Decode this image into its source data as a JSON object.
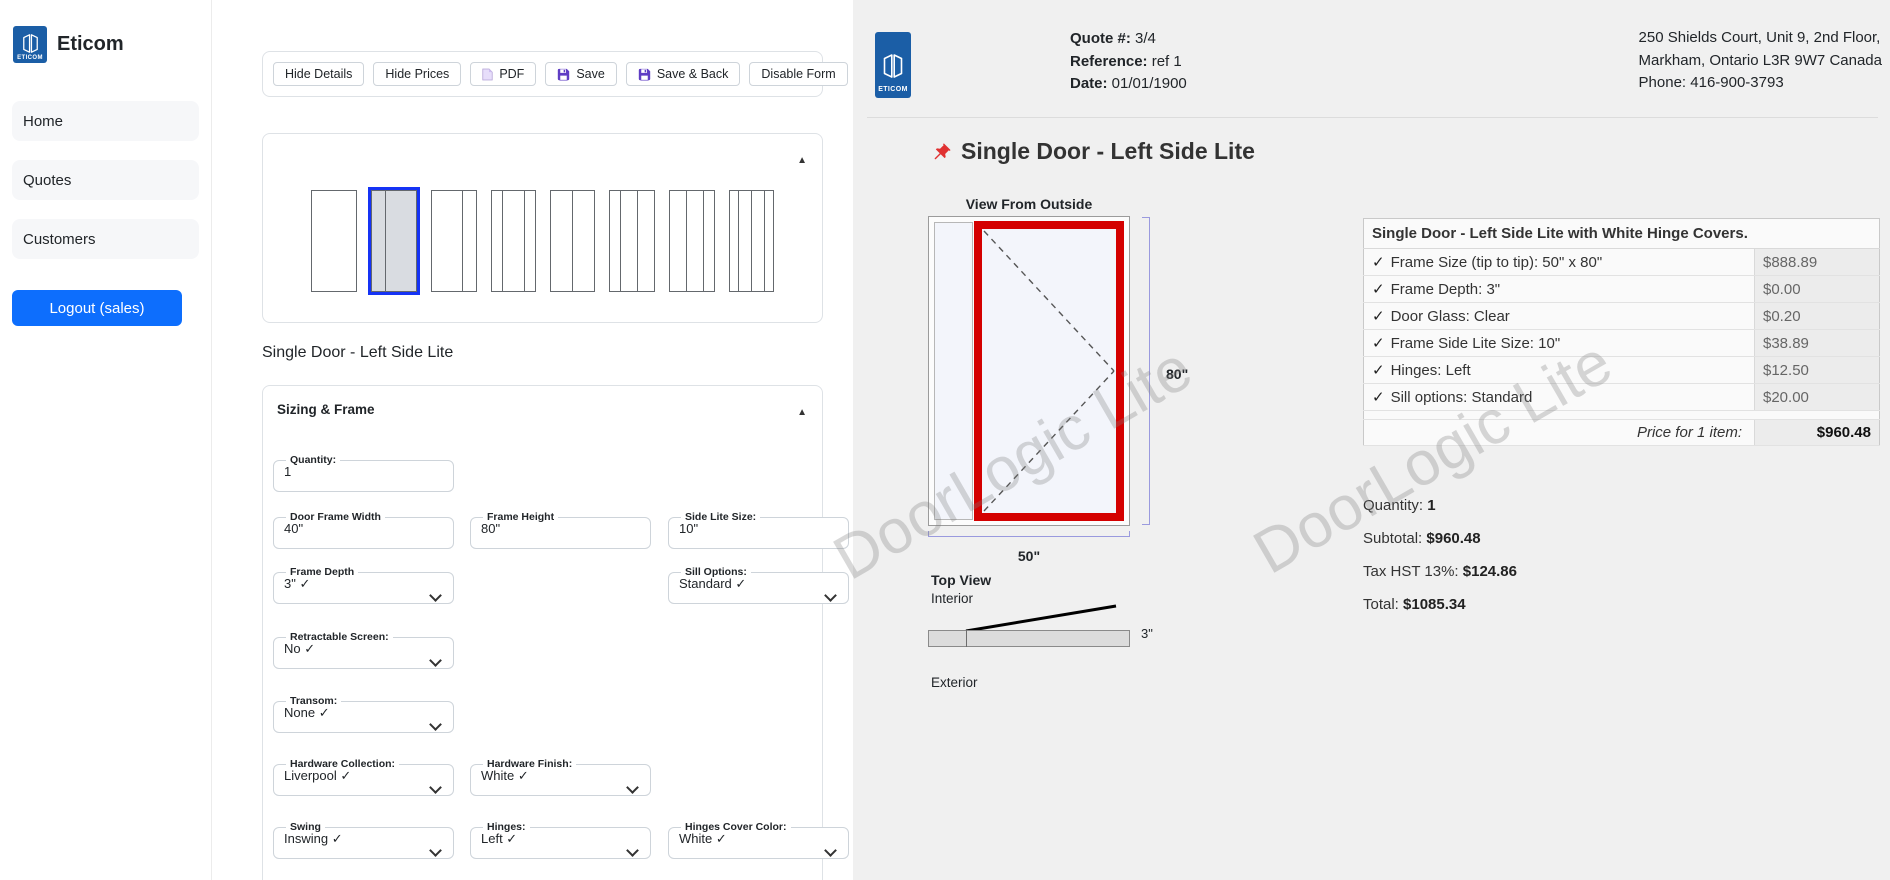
{
  "sidebar": {
    "brand": "Eticom",
    "logo_text": "ETICOM",
    "nav": [
      {
        "label": "Home"
      },
      {
        "label": "Quotes"
      },
      {
        "label": "Customers"
      }
    ],
    "logout_label": "Logout (sales)"
  },
  "toolbar": {
    "buttons": [
      {
        "label": "Hide Details",
        "icon": null
      },
      {
        "label": "Hide Prices",
        "icon": null
      },
      {
        "label": "PDF",
        "icon": "pdf-icon"
      },
      {
        "label": "Save",
        "icon": "floppy-icon"
      },
      {
        "label": "Save & Back",
        "icon": "floppy-icon"
      },
      {
        "label": "Disable Form",
        "icon": null
      }
    ]
  },
  "door_styles": {
    "selected_index": 1,
    "collapse_arrow": "▲",
    "options": [
      {
        "name": "single-door",
        "panels": [
          46
        ]
      },
      {
        "name": "single-door-left-side-lite",
        "panels": [
          15,
          32
        ]
      },
      {
        "name": "single-door-right-side-lite",
        "panels": [
          32,
          15
        ]
      },
      {
        "name": "single-door-both-side-lites",
        "panels": [
          12,
          23,
          12
        ]
      },
      {
        "name": "double-door",
        "panels": [
          23,
          23
        ]
      },
      {
        "name": "double-door-left-side-lite",
        "panels": [
          12,
          18,
          18
        ]
      },
      {
        "name": "double-door-right-side-lite",
        "panels": [
          18,
          18,
          12
        ]
      },
      {
        "name": "double-door-both-side-lites",
        "panels": [
          10,
          14,
          14,
          10
        ]
      }
    ]
  },
  "model_label": "Single Door - Left Side Lite",
  "form": {
    "section_title": "Sizing & Frame",
    "collapse_arrow": "▲",
    "fields": [
      {
        "label": "Quantity:",
        "value": "1",
        "type": "input",
        "col": 0,
        "row": 0
      },
      {
        "label": "Door Frame Width",
        "value": "40\"",
        "type": "input",
        "col": 0,
        "row": 1
      },
      {
        "label": "Frame Height",
        "value": "80\"",
        "type": "input",
        "col": 1,
        "row": 1
      },
      {
        "label": "Side Lite Size:",
        "value": "10\"",
        "type": "input",
        "col": 2,
        "row": 1
      },
      {
        "label": "Frame Depth",
        "value": "3\" ✓",
        "type": "select",
        "col": 0,
        "row": 2
      },
      {
        "label": "Sill Options:",
        "value": "Standard ✓",
        "type": "select",
        "col": 2,
        "row": 2
      },
      {
        "label": "Retractable Screen:",
        "value": "No ✓",
        "type": "select",
        "col": 0,
        "row": 3
      },
      {
        "label": "Transom:",
        "value": "None ✓",
        "type": "select",
        "col": 0,
        "row": 4
      },
      {
        "label": "Hardware Collection:",
        "value": "Liverpool ✓",
        "type": "select",
        "col": 0,
        "row": 5
      },
      {
        "label": "Hardware Finish:",
        "value": "White ✓",
        "type": "select",
        "col": 1,
        "row": 5
      },
      {
        "label": "Swing",
        "value": "Inswing ✓",
        "type": "select",
        "col": 0,
        "row": 6
      },
      {
        "label": "Hinges:",
        "value": "Left ✓",
        "type": "select",
        "col": 1,
        "row": 6
      },
      {
        "label": "Hinges Cover Color:",
        "value": "White ✓",
        "type": "select",
        "col": 2,
        "row": 6
      }
    ]
  },
  "quote_header": {
    "logo_text": "ETICOM",
    "items": [
      {
        "label": "Quote #:",
        "value": "3/4"
      },
      {
        "label": "Reference:",
        "value": "ref 1"
      },
      {
        "label": "Date:",
        "value": "01/01/1900"
      }
    ],
    "address_lines": [
      "250 Shields Court, Unit 9, 2nd Floor,",
      "Markham, Ontario L3R 9W7 Canada",
      "Phone: 416-900-3793"
    ]
  },
  "preview": {
    "title": "Single Door - Left Side Lite",
    "view_label": "View From Outside",
    "height_label": "80\"",
    "width_label": "50\"",
    "top_view_label": "Top View",
    "interior_label": "Interior",
    "exterior_label": "Exterior",
    "depth_label": "3\""
  },
  "price_table": {
    "header": "Single Door - Left Side Lite with White Hinge Covers.",
    "check_mark": "✓",
    "rows": [
      {
        "item": "Frame Size (tip to tip): 50\" x 80\"",
        "price": "$888.89"
      },
      {
        "item": "Frame Depth: 3\"",
        "price": "$0.00"
      },
      {
        "item": "Door Glass: Clear",
        "price": "$0.20"
      },
      {
        "item": "Frame Side Lite Size: 10\"",
        "price": "$38.89"
      },
      {
        "item": "Hinges: Left",
        "price": "$12.50"
      },
      {
        "item": "Sill options: Standard",
        "price": "$20.00"
      }
    ],
    "total_label": "Price for 1 item:",
    "total_value": "$960.48"
  },
  "totals": [
    {
      "label": "Quantity:",
      "value": "1"
    },
    {
      "label": "Subtotal:",
      "value": "$960.48"
    },
    {
      "label": "Tax HST 13%:",
      "value": "$124.86"
    },
    {
      "label": "Total:",
      "value": "$1085.34"
    }
  ],
  "watermark": {
    "text": "DoorLogic Lite"
  },
  "colors": {
    "accent_blue": "#0d6efd",
    "logo_blue": "#1b5ea6",
    "selected_style_blue": "#1533f5",
    "door_red": "#d40000",
    "save_icon_purple": "#5f3dc4",
    "panel_gray": "#f0f0f0"
  }
}
